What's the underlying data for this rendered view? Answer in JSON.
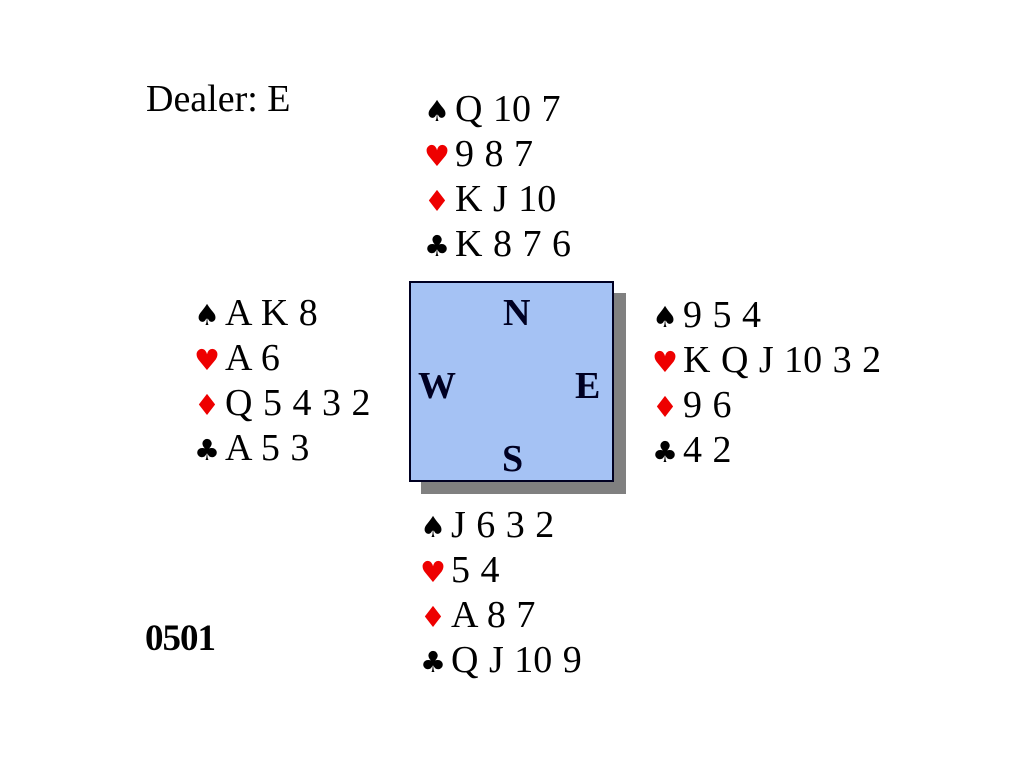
{
  "slide": {
    "dealer_label": "Dealer: E",
    "board_number": "0501"
  },
  "compass_box": {
    "north": "N",
    "west": "W",
    "east": "E",
    "south": "S",
    "fill_color": "#A5C2F4",
    "border_color": "#000022",
    "shadow_color": "#808080"
  },
  "suit_symbols": {
    "spade": "♠",
    "heart": "♥",
    "diamond": "♦",
    "club": "♣"
  },
  "suit_colors": {
    "spade": "#000000",
    "heart": "#EE0000",
    "diamond": "#EE0000",
    "club": "#000000"
  },
  "hands": {
    "north": {
      "spades": "Q 10 7",
      "hearts": "9 8 7",
      "diamonds": "K J 10",
      "clubs": "K 8 7 6"
    },
    "west": {
      "spades": "A K 8",
      "hearts": "A 6",
      "diamonds": "Q 5 4 3 2",
      "clubs": "A 5 3"
    },
    "east": {
      "spades": "9 5 4",
      "hearts": "K Q J 10 3 2",
      "diamonds": "9 6",
      "clubs": "4 2"
    },
    "south": {
      "spades": "J 6 3 2",
      "hearts": "5 4",
      "diamonds": "A 8 7",
      "clubs": "Q J 10 9"
    }
  }
}
